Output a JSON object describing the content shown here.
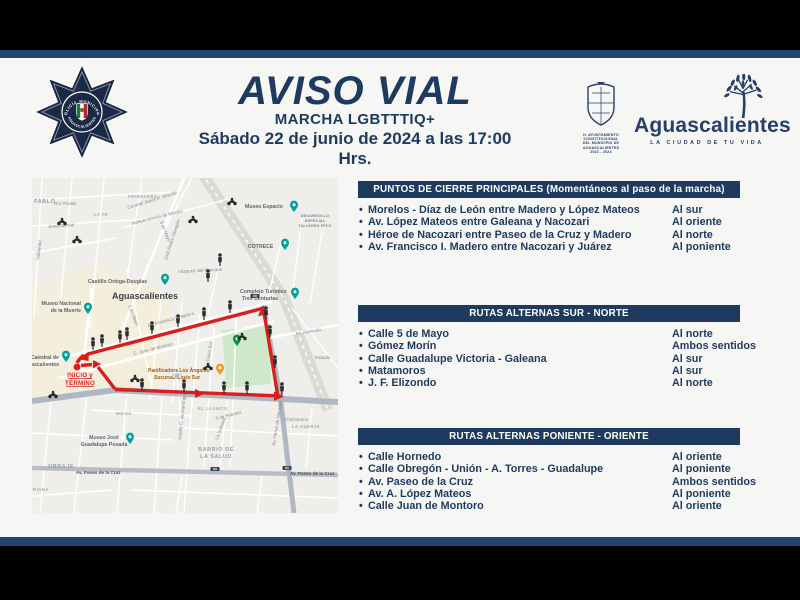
{
  "ui": {
    "bullet": "•"
  },
  "colors": {
    "navy": "#1e3a5f",
    "band": "#24426e",
    "route_red": "#d7201d",
    "pin_teal": "#00a39a",
    "pin_orange": "#f09a22"
  },
  "header": {
    "title": "AVISO VIAL",
    "subtitle": "MARCHA LGBTTTIQ+",
    "datetime": "Sábado 22 de junio de 2024 a las 17:00 Hrs.",
    "badge": {
      "top": "POLICÍA MUNICIPAL",
      "bottom": "AGUASCALIENTES"
    },
    "municipality": {
      "caption_1": "H. AYUNTAMIENTO CONSTITUCIONAL",
      "caption_2": "DEL MUNICIPIO DE AGUASCALIENTES",
      "caption_3": "2021 - 2024"
    },
    "brand": {
      "name": "Aguascalientes",
      "tagline": "LA CIUDAD DE TU VIDA"
    }
  },
  "sections": [
    {
      "title": "PUNTOS DE CIERRE PRINCIPALES (Momentáneos al paso de la marcha)",
      "rows": [
        {
          "street": "Morelos - Díaz de León entre Madero y López Mateos",
          "dir": "Al sur"
        },
        {
          "street": "Av. López Mateos entre Galeana y Nacozari",
          "dir": "Al oriente"
        },
        {
          "street": "Héroe de Nacozari entre Paseo de la Cruz y Madero",
          "dir": "Al norte"
        },
        {
          "street": "Av. Francisco I. Madero entre Nacozari y Juárez",
          "dir": "Al poniente"
        }
      ]
    },
    {
      "title": "RUTAS ALTERNAS SUR - NORTE",
      "rows": [
        {
          "street": "Calle 5 de Mayo",
          "dir": "Al norte"
        },
        {
          "street": "Gómez Morín",
          "dir": "Ambos sentidos"
        },
        {
          "street": "Calle Guadalupe Victoria - Galeana",
          "dir": "Al sur"
        },
        {
          "street": "Matamoros",
          "dir": "Al sur"
        },
        {
          "street": "J. F. Elizondo",
          "dir": "Al norte"
        }
      ]
    },
    {
      "title": "RUTAS ALTERNAS PONIENTE - ORIENTE",
      "rows": [
        {
          "street": "Calle Hornedo",
          "dir": "Al oriente"
        },
        {
          "street": "Calle Obregón - Unión - A. Torres - Guadalupe",
          "dir": "Al poniente"
        },
        {
          "street": "Av. Paseo de la Cruz",
          "dir": "Ambos sentidos"
        },
        {
          "street": "Av. A. López Mateos",
          "dir": "Al poniente"
        },
        {
          "street": "Calle Juan de Montoro",
          "dir": "Al oriente"
        }
      ]
    }
  ],
  "map": {
    "city": "Aguascalientes",
    "start_line1": "INICIO y",
    "start_line2": "TÉRMINO",
    "areas": {
      "pablo": "PABLO",
      "primavera": "PRIMAVERA",
      "la_fe": "LA FE",
      "obraje": "OBRAJE",
      "barrio_1": "BARRIO DE",
      "barrio_2": "LA SALUD",
      "llanito": "EL LLANITO",
      "huerta": "LA HUERTA",
      "triana": "TRIANA",
      "estadio": "Estadio"
    },
    "pois": {
      "museo_espacio": "Museo Espacio",
      "desarrollo_1": "DESARROLLO",
      "desarrollo_2": "ESPECIAL",
      "desarrollo_3": "TALLERES FFCC",
      "cotrece": "COTRECE",
      "castillo": "Castillo Ortega-Douglas",
      "museo_muerte_1": "Museo Nacional",
      "museo_muerte_2": "de la Muerte",
      "complejo_1": "Complejo Turístico",
      "complejo_2": "Tres Centurias",
      "catedral_1": "Catedral de",
      "catedral_2": "Aguascalientes",
      "panificadora_1": "Panificadora Los Ángeles",
      "panificadora_2": "Sucursal Cosío Sur",
      "posada_1": "Museo José",
      "posada_2": "Guadalupe Posada"
    },
    "streets": {
      "rio_pirules": "Río Pirules",
      "jesus_bernal": "Jesús Bernal",
      "valladolid": "Valladolid",
      "cinco_de_mayo": "5 de Mayo",
      "macias": "Coronel Jesús R. Macías",
      "independencia": "Independencia de México",
      "obregon": "Gral Álvaro Obregón",
      "vazquez": "Vázquez del Mercado",
      "madero": "Av. Francisco I. Madero",
      "montoro": "C. Juan de Montoro",
      "alameda": "Av. Alameda",
      "nacozari": "Av. Héroe de Nacozari",
      "del_sol": "Del Sol",
      "cinco_febrero": "5 de Febrero",
      "soledad": "La Soledad",
      "cosio": "Cosío Sur",
      "paseo_cruz": "Av. Paseo de la Cruz",
      "chichimeco": "Chichimeco",
      "josefa": "Josefa O. de Domínguez"
    }
  }
}
